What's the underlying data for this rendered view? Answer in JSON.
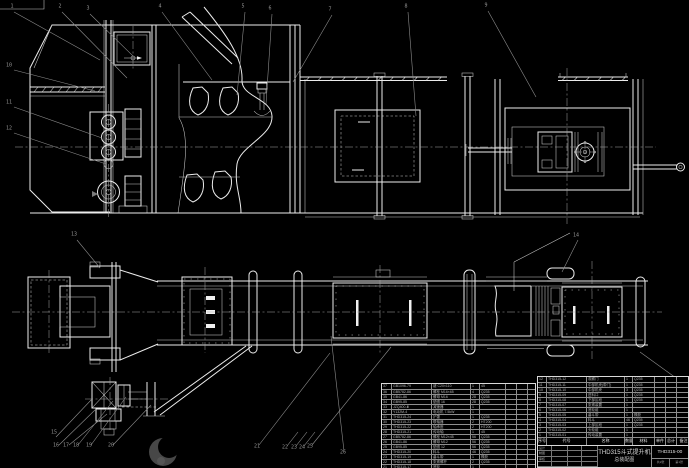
{
  "drawing": {
    "product_code": "THD315-00",
    "title_line1": "THD315斗式提升机",
    "title_line2": "总装配图",
    "colors": {
      "background": "#000000",
      "line": "#ececec",
      "leader": "#8d8d8d"
    }
  },
  "callouts": [
    {
      "x": 12,
      "y": 7,
      "label": "1"
    },
    {
      "x": 60,
      "y": 7,
      "label": "2"
    },
    {
      "x": 88,
      "y": 9,
      "label": "3"
    },
    {
      "x": 160,
      "y": 7,
      "label": "4"
    },
    {
      "x": 243,
      "y": 7,
      "label": "5"
    },
    {
      "x": 270,
      "y": 9,
      "label": "6"
    },
    {
      "x": 330,
      "y": 10,
      "label": "7"
    },
    {
      "x": 406,
      "y": 7,
      "label": "8"
    },
    {
      "x": 486,
      "y": 6,
      "label": "9"
    },
    {
      "x": 9,
      "y": 66,
      "label": "10"
    },
    {
      "x": 9,
      "y": 103,
      "label": "11"
    },
    {
      "x": 9,
      "y": 129,
      "label": "12"
    },
    {
      "x": 74,
      "y": 235,
      "label": "13"
    },
    {
      "x": 576,
      "y": 236,
      "label": "14"
    },
    {
      "x": 54,
      "y": 433,
      "label": "15"
    },
    {
      "x": 56,
      "y": 446,
      "label": "16"
    },
    {
      "x": 66,
      "y": 446,
      "label": "17"
    },
    {
      "x": 76,
      "y": 446,
      "label": "18"
    },
    {
      "x": 89,
      "y": 446,
      "label": "19"
    },
    {
      "x": 111,
      "y": 446,
      "label": "20"
    },
    {
      "x": 257,
      "y": 447,
      "label": "21"
    },
    {
      "x": 285,
      "y": 448,
      "label": "22"
    },
    {
      "x": 294,
      "y": 448,
      "label": "23"
    },
    {
      "x": 302,
      "y": 448,
      "label": "24"
    },
    {
      "x": 310,
      "y": 447,
      "label": "25"
    },
    {
      "x": 343,
      "y": 453,
      "label": "26"
    }
  ],
  "left_parts_table": {
    "x": 381,
    "y": 383,
    "row_height": 5,
    "col_widths": [
      10,
      40,
      39,
      9,
      26,
      11,
      11,
      9
    ],
    "rows": [
      [
        "37",
        "GB1096-79",
        "键 C20×110",
        "1",
        "45",
        "",
        "",
        " "
      ],
      [
        "36",
        "GB5782-86",
        "螺栓 M16×65",
        "4",
        "Q235",
        "",
        "",
        " "
      ],
      [
        "35",
        "GB41-86",
        "螺母 M16",
        "28",
        "Q235",
        "",
        "",
        " "
      ],
      [
        "34",
        "GB95-85",
        "垫圈 16",
        "28",
        "Q235",
        "",
        "",
        " "
      ],
      [
        "33",
        "JZQ400-Ⅲ",
        "减速器",
        "1",
        "",
        "",
        "",
        " "
      ],
      [
        "32",
        "Y132M-4",
        "电动机 7.5kW",
        "1",
        "",
        "",
        "",
        " "
      ],
      [
        "31",
        "THD315-24",
        "护罩",
        "1",
        "Q235",
        "",
        "",
        " "
      ],
      [
        "30",
        "THD315-23",
        "联轴器",
        "2",
        "HT200",
        "",
        "",
        " "
      ],
      [
        "29",
        "THD315-22",
        "轴承座",
        "2",
        "HT200",
        "",
        "",
        " "
      ],
      [
        "28",
        "THD315-21",
        "传动轴",
        "1",
        "45",
        "",
        "",
        " "
      ],
      [
        "27",
        "GB5782-86",
        "螺栓 M12×45",
        "56",
        "Q235",
        "",
        "",
        " "
      ],
      [
        "26",
        "GB41-86",
        "螺母 M12",
        "56",
        "Q235",
        "",
        "",
        " "
      ],
      [
        "25",
        "GB95-85",
        "垫圈 12",
        "56",
        "Q235",
        "",
        "",
        " "
      ],
      [
        "24",
        "THD315-20",
        "料斗",
        "46",
        "Q235",
        "",
        "",
        " "
      ],
      [
        "23",
        "THD315-19",
        "畚斗带",
        "1",
        "橡胶",
        "",
        "",
        " "
      ],
      [
        "22",
        "THD315-18",
        "张紧螺杆",
        "2",
        "Q235",
        "",
        "",
        " "
      ],
      [
        "21",
        "THD315-17",
        "底轮",
        "1",
        "",
        "",
        "",
        " "
      ]
    ]
  },
  "right_parts_table": {
    "x": 537,
    "y": 376,
    "row_height": 5,
    "header_height": 9,
    "col_widths": [
      9,
      40,
      38,
      8,
      22,
      11,
      11,
      13
    ],
    "header": [
      "序号",
      "代号",
      "名称",
      "数量",
      "材料",
      "单件",
      "总计",
      "备注"
    ],
    "rows": [
      [
        "12",
        "THD315-12",
        "观察门",
        "1",
        "Q235",
        "",
        "",
        " "
      ],
      [
        "11",
        "THD315-11",
        "中部机壳(带门)",
        "1",
        "Q235",
        "",
        "",
        " "
      ],
      [
        "10",
        "THD315-10",
        "中部机壳",
        "3",
        "Q235",
        "",
        "",
        " "
      ],
      [
        "9",
        "THD315-09",
        "进料口",
        "1",
        "Q235",
        "",
        "",
        " "
      ],
      [
        "8",
        "THD315-08",
        "下部区段",
        "1",
        "Q235",
        "",
        "",
        " "
      ],
      [
        "7",
        "THD315-07",
        "张紧装置",
        "1",
        "",
        "",
        "",
        " "
      ],
      [
        "6",
        "THD315-06",
        "底轮组",
        "1",
        "",
        "",
        "",
        " "
      ],
      [
        "5",
        "THD315-05",
        "畚斗带",
        "1",
        "橡胶",
        "",
        "",
        " "
      ],
      [
        "4",
        "THD315-04",
        "料斗",
        "46",
        "Q235",
        "",
        "",
        " "
      ],
      [
        "3",
        "THD315-03",
        "上部区段",
        "1",
        "Q235",
        "",
        "",
        " "
      ],
      [
        "2",
        "THD315-02",
        "头轮组",
        "1",
        "",
        "",
        "",
        " "
      ],
      [
        "1",
        "THD315-01",
        "传动装置",
        "1",
        "",
        "",
        "",
        " "
      ]
    ]
  },
  "title_block": {
    "x": 537,
    "y": 445,
    "width": 152,
    "height": 23,
    "left_grid_labels": [
      [
        "设计",
        "",
        "",
        ""
      ],
      [
        "制图",
        "",
        "",
        ""
      ],
      [
        "审核",
        "",
        "",
        ""
      ],
      [
        "",
        "",
        "",
        ""
      ]
    ],
    "right_bottom": [
      "共2张",
      "第1张"
    ]
  }
}
